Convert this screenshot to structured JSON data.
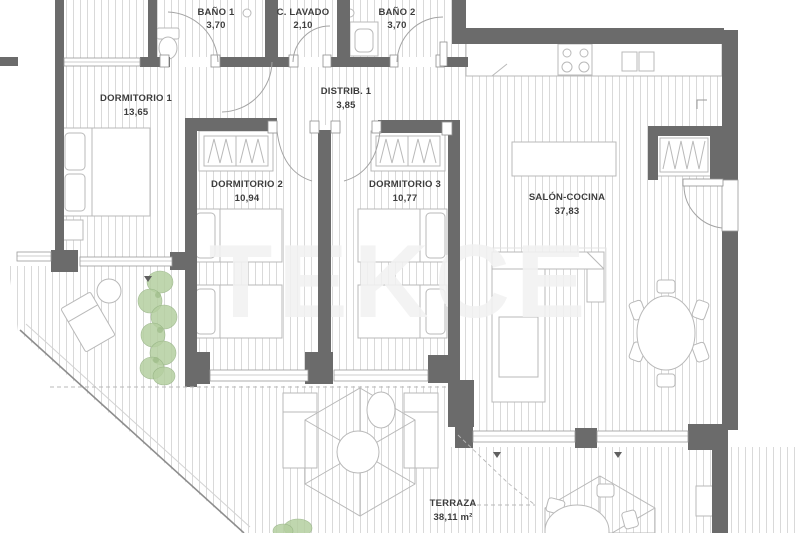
{
  "plan": {
    "watermark": "TEKCE",
    "rooms": [
      {
        "id": "bano1",
        "name": "BAÑO 1",
        "area": "3,70"
      },
      {
        "id": "lavado",
        "name": "C. LAVADO",
        "area": "2,10"
      },
      {
        "id": "bano2",
        "name": "BAÑO 2",
        "area": "3,70"
      },
      {
        "id": "dormitorio1",
        "name": "DORMITORIO 1",
        "area": "13,65"
      },
      {
        "id": "distribuidor",
        "name": "DISTRIB. 1",
        "area": "3,85"
      },
      {
        "id": "dormitorio2",
        "name": "DORMITORIO 2",
        "area": "10,94"
      },
      {
        "id": "dormitorio3",
        "name": "DORMITORIO 3",
        "area": "10,77"
      },
      {
        "id": "salon-cocina",
        "name": "SALÓN-COCINA",
        "area": "37,83"
      },
      {
        "id": "terraza",
        "name": "TERRAZA",
        "area": "38,11 m²"
      }
    ],
    "colors": {
      "wall": "#6b6b6b",
      "hatch": "#d9d9d9",
      "furniture": "#b9b9b9",
      "label": "#3d3d3d",
      "plant": "#b5cfa0",
      "watermark": "#f2f2f2"
    }
  }
}
